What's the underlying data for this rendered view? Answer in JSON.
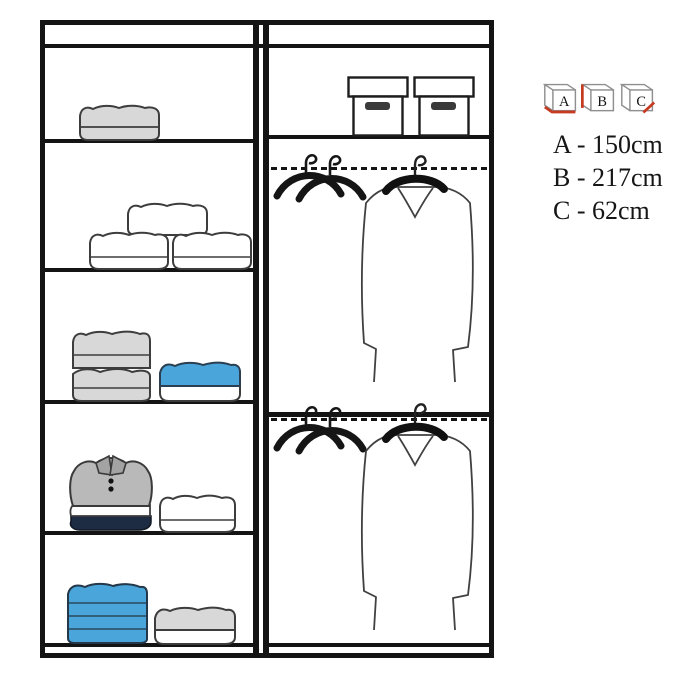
{
  "legend": {
    "icons": [
      {
        "label": "A",
        "accent": "width-edge"
      },
      {
        "label": "B",
        "accent": "height-edge"
      },
      {
        "label": "C",
        "accent": "depth-edge"
      }
    ],
    "dimensions": [
      {
        "letter": "A",
        "value": "150cm",
        "text": "A - 150cm"
      },
      {
        "letter": "B",
        "value": "217cm",
        "text": "B - 217cm"
      },
      {
        "letter": "C",
        "value": "62cm",
        "text": "C - 62cm"
      }
    ]
  },
  "wardrobe": {
    "left_column": {
      "shelves": [
        {
          "items": [
            "folded-blanket-grey"
          ]
        },
        {
          "items": [
            "folded-pillow-white",
            "folded-pillow-white",
            "folded-pillow-white"
          ]
        },
        {
          "items": [
            "folded-blanket-stack-grey",
            "folded-item-blue-on-white"
          ]
        },
        {
          "items": [
            "folded-polo-shirt-stack",
            "folded-item-white"
          ]
        },
        {
          "items": [
            "folded-stack-blue",
            "folded-item-grey-on-white"
          ]
        }
      ]
    },
    "right_column": {
      "top_shelf_items": [
        "storage-box",
        "storage-box"
      ],
      "hanging_sections": [
        {
          "items": [
            "clothes-hangers-pair",
            "hanging-garment"
          ]
        },
        {
          "items": [
            "clothes-hangers-pair",
            "hanging-garment"
          ]
        }
      ]
    }
  },
  "colors": {
    "outline": "#141414",
    "item_grey": "#d8d8d8",
    "item_blue": "#49a5da",
    "polo_navy": "#1d2b43",
    "legend_red": "#c63a21"
  }
}
